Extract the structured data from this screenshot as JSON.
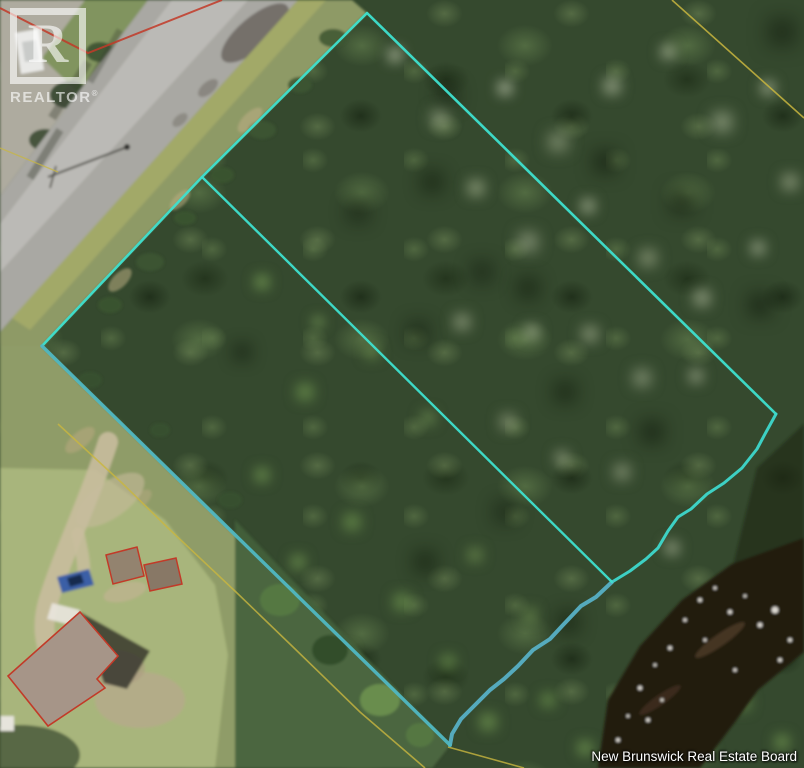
{
  "watermark": {
    "logo_letter": "R",
    "logo_text": "REALTOR",
    "registered_mark": "®"
  },
  "attribution": {
    "text": "New Brunswick Real Estate Board"
  },
  "overlay": {
    "colors": {
      "boundary_front": "#3ee0cf",
      "boundary_river_upper": "#3ed8cc",
      "boundary_river_lower": "#57b0c5",
      "boundary_rear": "#50b7c2",
      "interior_division": "#3ee0cf",
      "neighbor_lot_line": "#c9b63e",
      "structure_outline": "#c23a28"
    },
    "subject_parcel": {
      "front_edges_points": "42,346 202,177 367,13 776,414",
      "river_edge_upper_points": "776,414 765,434 757,449 742,468 724,483 707,494 691,509 678,517 668,531 658,548 646,559 630,571 612,582",
      "river_edge_lower_points": "612,582 596,597 581,606 563,625 550,639 533,650 518,666 504,679 490,690 474,706 461,719 452,734 450,745",
      "rear_edge_points": "450,745 42,346",
      "interior_division_points": "202,177 612,582"
    },
    "neighbor_lines": {
      "right_line_points": "672,0 804,118",
      "left_line_points": "58,424 122,483 168,528 236,592 292,646 360,712 425,768",
      "corner_line_points": "448,747 524,768",
      "road_line_points": "0,148 58,172",
      "red_corner_points": "0,8 88,53 222,0"
    },
    "structures": {
      "house_points": "80,612 118,656 97,679 105,688 48,726 8,676",
      "shed1_points": "106,555 137,547 144,576 113,584",
      "shed2_points": "144,565 176,558 182,584 150,591"
    }
  }
}
